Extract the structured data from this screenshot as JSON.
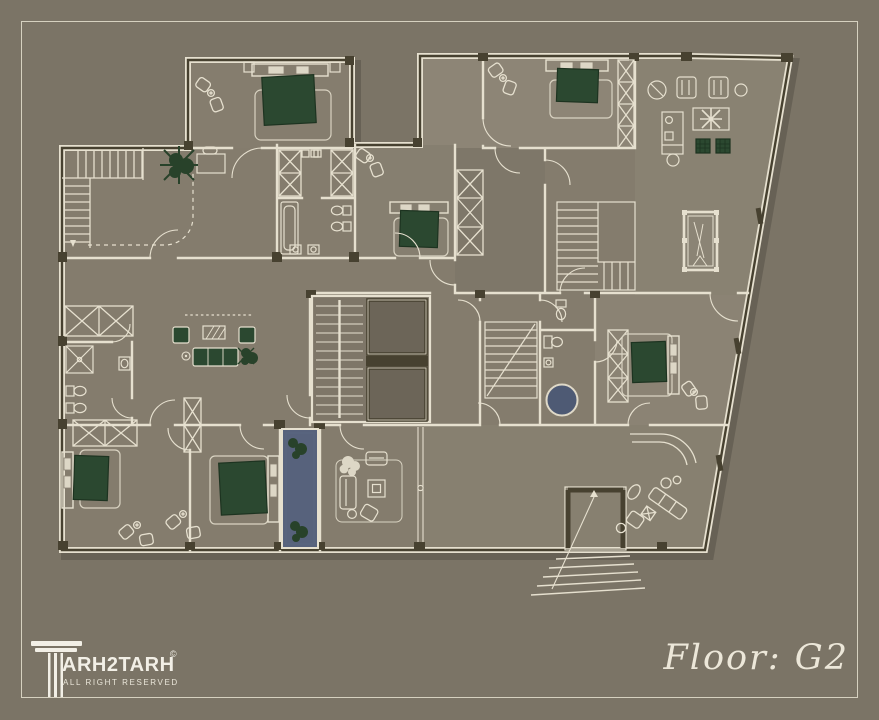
{
  "page": {
    "background_color": "#7b7466",
    "frame_color": "#d6d1c0"
  },
  "branding": {
    "icon": "column-icon",
    "brand_display": "ARH2TARH",
    "brand_full": "TARH2TARH",
    "copyright_symbol": "©",
    "tagline": "ALL RIGHT RESERVED"
  },
  "floor_label": {
    "text": "Floor: G2"
  },
  "plan": {
    "type": "residential-architectural-floor-plan",
    "floor": "G2",
    "palette": {
      "floor": "#847c6d",
      "floor_light": "#8d8576",
      "wall_line": "#e6e0cf",
      "wall_dark": "#474130",
      "bed_green": "#2b4830",
      "plant_green": "#28422a",
      "water_blue": "#57627c",
      "tub_blue": "#4e5a74",
      "shaft_fill": "#6c6558"
    },
    "rooms": [
      {
        "name": "bedroom-top-left",
        "furniture": [
          "double-bed",
          "two-armchairs",
          "side-table"
        ]
      },
      {
        "name": "entry-hall",
        "furniture": [
          "l-shaped-staircase",
          "desk",
          "plant",
          "dashed-ceiling-line"
        ]
      },
      {
        "name": "living-room-left",
        "furniture": [
          "green-sofa-set",
          "tv-rug",
          "floor-lamp",
          "plant",
          "closet"
        ]
      },
      {
        "name": "bathroom-left",
        "furniture": [
          "shower",
          "toilet",
          "bidet",
          "sink"
        ]
      },
      {
        "name": "bedroom-bottom-left",
        "furniture": [
          "double-bed",
          "two-armchairs"
        ]
      },
      {
        "name": "bedroom-bottom-middle",
        "furniture": [
          "double-bed",
          "two-armchairs",
          "wardrobe"
        ]
      },
      {
        "name": "indoor-lap-pool",
        "furniture": [
          "water-basin",
          "plants"
        ]
      },
      {
        "name": "family-living-room",
        "furniture": [
          "white-sofa-set",
          "square-table",
          "tree-plant"
        ]
      },
      {
        "name": "open-hall-bottom-right",
        "furniture": [
          "curved-wall",
          "angled-sofa-set"
        ]
      },
      {
        "name": "hall-closets",
        "furniture": [
          "two-wardrobes",
          "shelf-row"
        ]
      },
      {
        "name": "bathroom-top-middle",
        "furniture": [
          "bathtub",
          "two-toilets",
          "two-sinks"
        ]
      },
      {
        "name": "bedroom-middle",
        "furniture": [
          "double-bed",
          "two-armchairs",
          "wardrobe"
        ]
      },
      {
        "name": "bedroom-top-right",
        "furniture": [
          "double-bed",
          "two-armchairs",
          "tall-wardrobe"
        ]
      },
      {
        "name": "lounge-top-right",
        "furniture": [
          "two-sofas",
          "plant-table",
          "round-chairs",
          "kitchen-counter",
          "two-green-ottomans"
        ]
      },
      {
        "name": "game-room",
        "furniture": [
          "billiard-table",
          "interior-staircase"
        ]
      },
      {
        "name": "stair-hall-core",
        "furniture": [
          "switchback-staircase",
          "two-elevator-shafts",
          "secondary-staircase"
        ]
      },
      {
        "name": "bathroom-jacuzzi",
        "furniture": [
          "round-tub",
          "toilet",
          "sink"
        ]
      },
      {
        "name": "wc-small",
        "furniture": [
          "toilet"
        ]
      },
      {
        "name": "bedroom-right",
        "furniture": [
          "double-bed",
          "wardrobe",
          "two-armchairs"
        ]
      },
      {
        "name": "exterior-entry",
        "furniture": [
          "fan-staircase",
          "landing"
        ]
      }
    ],
    "features": [
      "slanted-right-facade",
      "two-elevators",
      "five-staircases",
      "lap-pool",
      "round-jacuzzi",
      "billiard-table"
    ]
  }
}
